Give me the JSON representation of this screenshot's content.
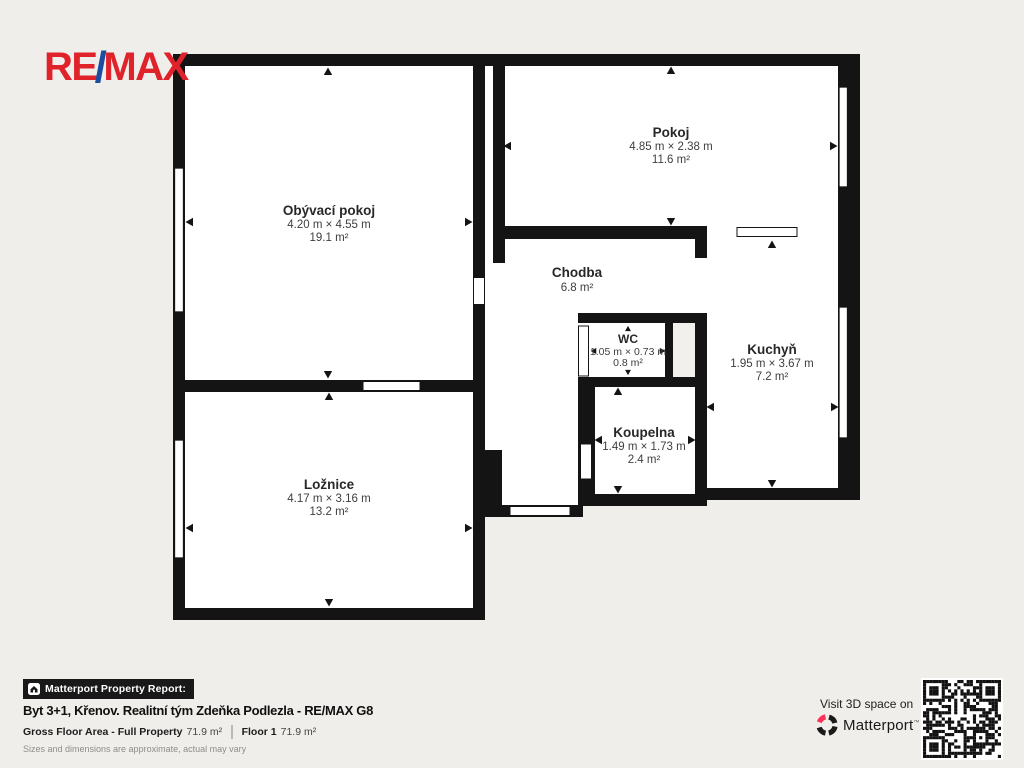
{
  "logo": {
    "re": "RE",
    "slash": "/",
    "max": "MAX"
  },
  "rooms": [
    {
      "name": "Obývací pokoj",
      "dims": "4.20 m × 4.55 m",
      "area": "19.1 m²"
    },
    {
      "name": "Pokoj",
      "dims": "4.85 m × 2.38 m",
      "area": "11.6 m²"
    },
    {
      "name": "Chodba",
      "dims": "",
      "area": "6.8 m²"
    },
    {
      "name": "WC",
      "dims": "1.05 m × 0.73 m",
      "area": "0.8 m²"
    },
    {
      "name": "Kuchyň",
      "dims": "1.95 m × 3.67 m",
      "area": "7.2 m²"
    },
    {
      "name": "Koupelna",
      "dims": "1.49 m × 1.73 m",
      "area": "2.4 m²"
    },
    {
      "name": "Ložnice",
      "dims": "4.17 m × 3.16 m",
      "area": "13.2 m²"
    }
  ],
  "footer": {
    "bar_label": "Matterport Property Report:",
    "title": "Byt 3+1, Křenov. Realitní tým Zdeňka Podlezla - RE/MAX G8",
    "gfa_label": "Gross Floor Area - Full Property",
    "gfa_value": "71.9 m²",
    "floor_label": "Floor 1",
    "floor_value": "71.9 m²",
    "disclaimer": "Sizes and dimensions are approximate, actual may vary"
  },
  "cta": {
    "visit_label": "Visit 3D space on",
    "brand": "Matterport",
    "trademark": "™"
  },
  "colors": {
    "background": "#f0eeea",
    "wall": "#141414",
    "remax_red": "#e0232b",
    "remax_blue": "#1c4ea0",
    "matterport_pink": "#ff3158",
    "bar_black": "#191919"
  }
}
